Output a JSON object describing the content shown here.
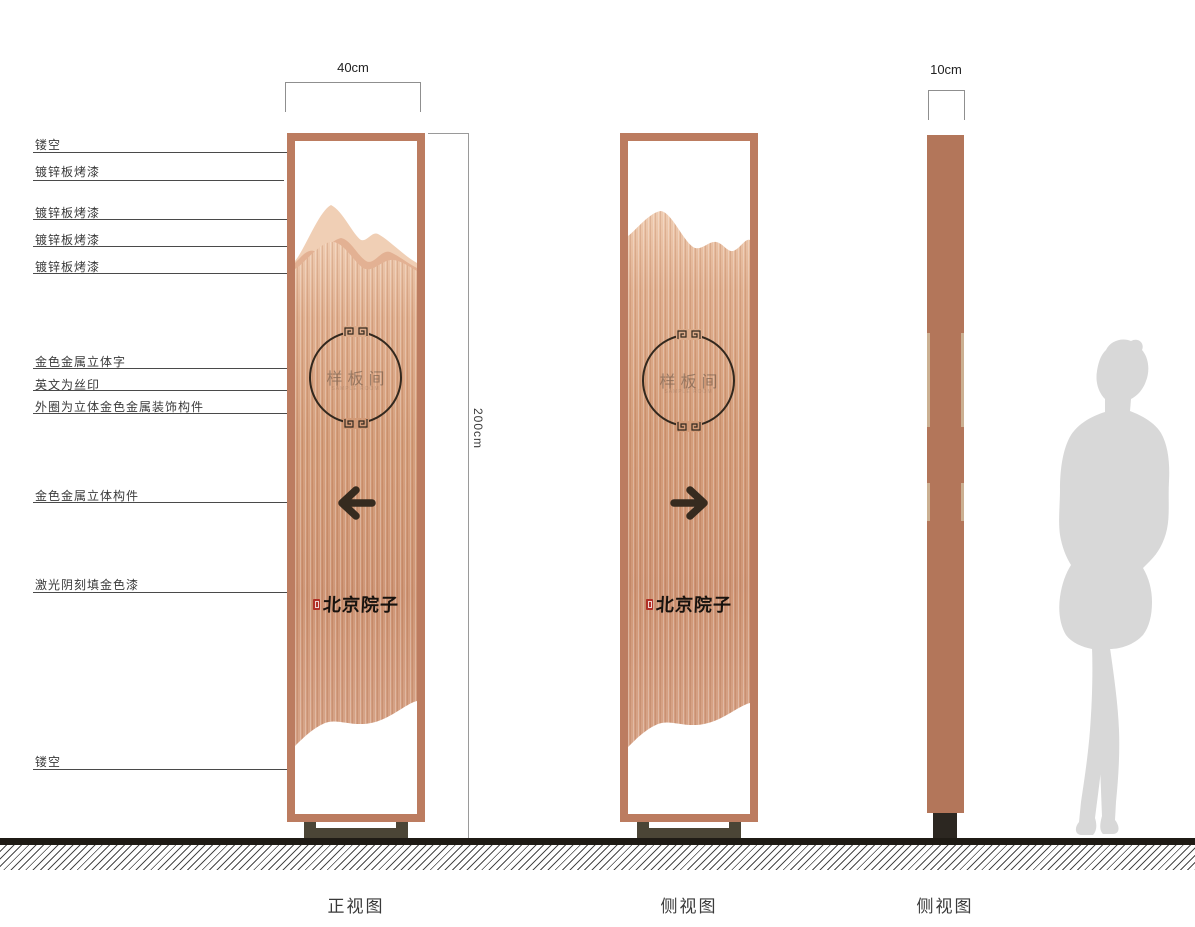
{
  "annotations": {
    "callouts": [
      {
        "text": "镂空"
      },
      {
        "text": "镀锌板烤漆"
      },
      {
        "text": "镀锌板烤漆"
      },
      {
        "text": "镀锌板烤漆"
      },
      {
        "text": "镀锌板烤漆"
      },
      {
        "text": "金色金属立体字"
      },
      {
        "text": "英文为丝印"
      },
      {
        "text": "外圈为立体金色金属装饰构件"
      },
      {
        "text": "金色金属立体构件"
      },
      {
        "text": "激光阴刻填金色漆"
      },
      {
        "text": "镂空"
      }
    ],
    "dimensions": {
      "front_width": "40cm",
      "side_width": "10cm",
      "height": "200cm"
    }
  },
  "sign": {
    "room_label": "样板间",
    "room_sublabel": "SAMPLE ROOM",
    "brand_label": "北京院子"
  },
  "icons": {
    "front_arrow": "arrow-left",
    "side_arrow": "arrow-right",
    "ring_ornament": "meander-pattern",
    "seal": "red-calligraphy-seal"
  },
  "views": [
    {
      "label": "正视图"
    },
    {
      "label": "侧视图"
    },
    {
      "label": "侧视图"
    }
  ],
  "colors": {
    "frame_copper": "#bc7c60",
    "panel_light": "#eec9ad",
    "panel_deep": "#cd9271",
    "mountain_back": "#f0cfb5",
    "mountain_mid": "#e3b193",
    "side_column": "#b3765a",
    "base_olive": "#4b4536",
    "ink": "#32281e",
    "seal_red": "#b03026",
    "silhouette_gray": "#d8d8d8",
    "ground": "#1f1b15"
  }
}
